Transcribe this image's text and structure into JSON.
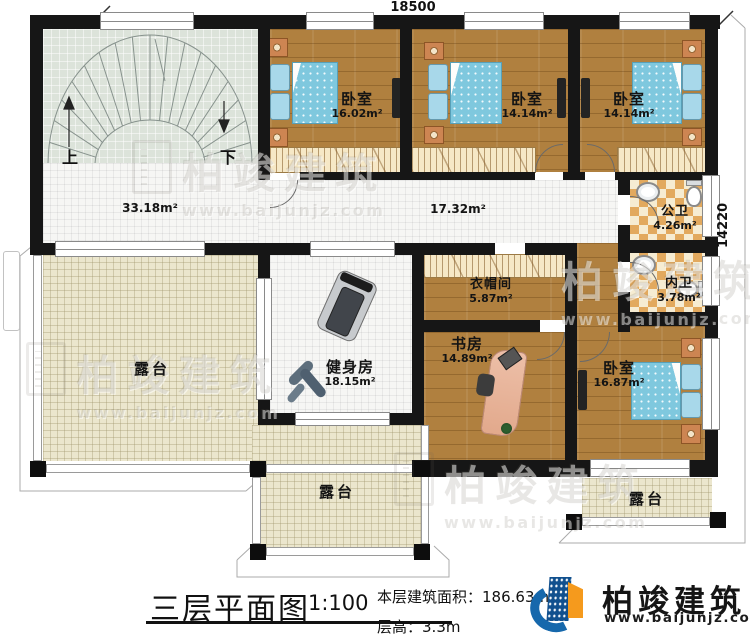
{
  "plan": {
    "dim_top": "18500",
    "dim_right": "14220",
    "stair_up": "上",
    "stair_down": "下",
    "hall_area": "33.18m²",
    "corridor_area": "17.32m²",
    "rooms": [
      {
        "name": "卧室",
        "area": "16.02m²"
      },
      {
        "name": "卧室",
        "area": "14.14m²"
      },
      {
        "name": "卧室",
        "area": "14.14m²"
      },
      {
        "name": "公卫",
        "area": "4.26m²"
      },
      {
        "name": "内卫",
        "area": "3.78m²"
      },
      {
        "name": "衣帽间",
        "area": "5.87m²"
      },
      {
        "name": "书房",
        "area": "14.89m²"
      },
      {
        "name": "卧室",
        "area": "16.87m²"
      },
      {
        "name": "健身房",
        "area": "18.15m²"
      },
      {
        "name": "露台"
      },
      {
        "name": "露台"
      },
      {
        "name": "露台"
      }
    ]
  },
  "footer": {
    "title": "三层平面图",
    "scale": "1:100",
    "area_label": "本层建筑面积：",
    "area_value": "186.63m²",
    "height_label": "层高：",
    "height_value": "3.3m"
  },
  "brand": {
    "name": "柏竣建筑",
    "url": "www.baijunjz.com"
  },
  "watermark": {
    "name": "柏竣建筑",
    "url": "www.baijunjz.com"
  },
  "colors": {
    "wall": "#161616",
    "wood_floor": "#b0803f",
    "white_tile": "#f6f6f4",
    "stair_tile": "#dce3da",
    "terrace_tile": "#ebe6cd",
    "bath_checker": "#e2a95e",
    "bed_blue": "#7fc8de",
    "brand_blue": "#1668ac",
    "brand_orange": "#f59a1d"
  }
}
